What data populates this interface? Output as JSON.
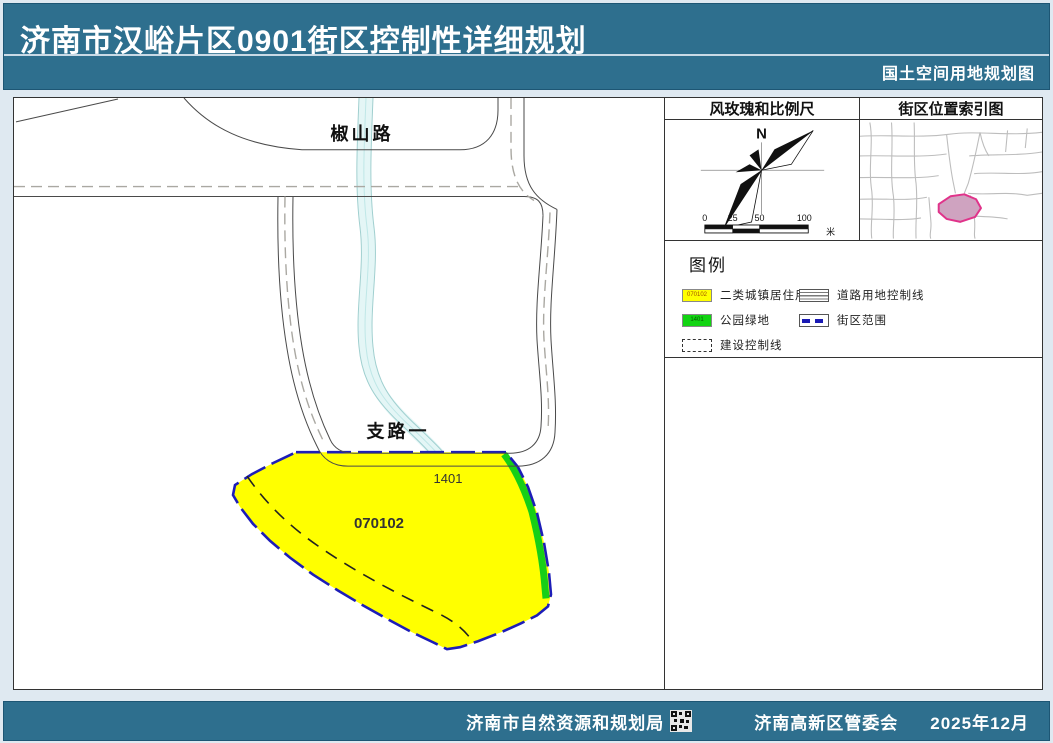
{
  "header": {
    "title": "济南市汉峪片区0901街区控制性详细规划",
    "subtitle": "国土空间用地规划图"
  },
  "panels": {
    "windrose": {
      "title": "风玫瑰和比例尺",
      "north_label": "N",
      "scale_ticks": [
        "0",
        "25",
        "50",
        "100"
      ],
      "unit": "米"
    },
    "index_map": {
      "title": "街区位置索引图"
    },
    "legend": {
      "title": "图例",
      "items": [
        {
          "code": "070102",
          "label": "二类城镇居住用地"
        },
        {
          "label": "道路用地控制线"
        },
        {
          "code": "1401",
          "label": "公园绿地"
        },
        {
          "label": "街区范围"
        },
        {
          "label": "建设控制线"
        }
      ]
    }
  },
  "map": {
    "road_labels": [
      {
        "text": "椒山路"
      },
      {
        "text": "支路一"
      }
    ],
    "parcel_labels": [
      {
        "text": "070102"
      },
      {
        "text": "1401"
      }
    ]
  },
  "footer": {
    "agency_left": "济南市自然资源和规划局",
    "agency_right": "济南高新区管委会",
    "date": "2025年12月"
  },
  "colors": {
    "header_teal": "#2e6f8e",
    "residential_yellow": "#ffff00",
    "park_green": "#12d412",
    "block_boundary_blue": "#1a1ab4",
    "stream_cyan": "#e4f6f6",
    "index_parcel_pink": "#cfa3c0",
    "index_parcel_stroke": "#e0338a"
  }
}
